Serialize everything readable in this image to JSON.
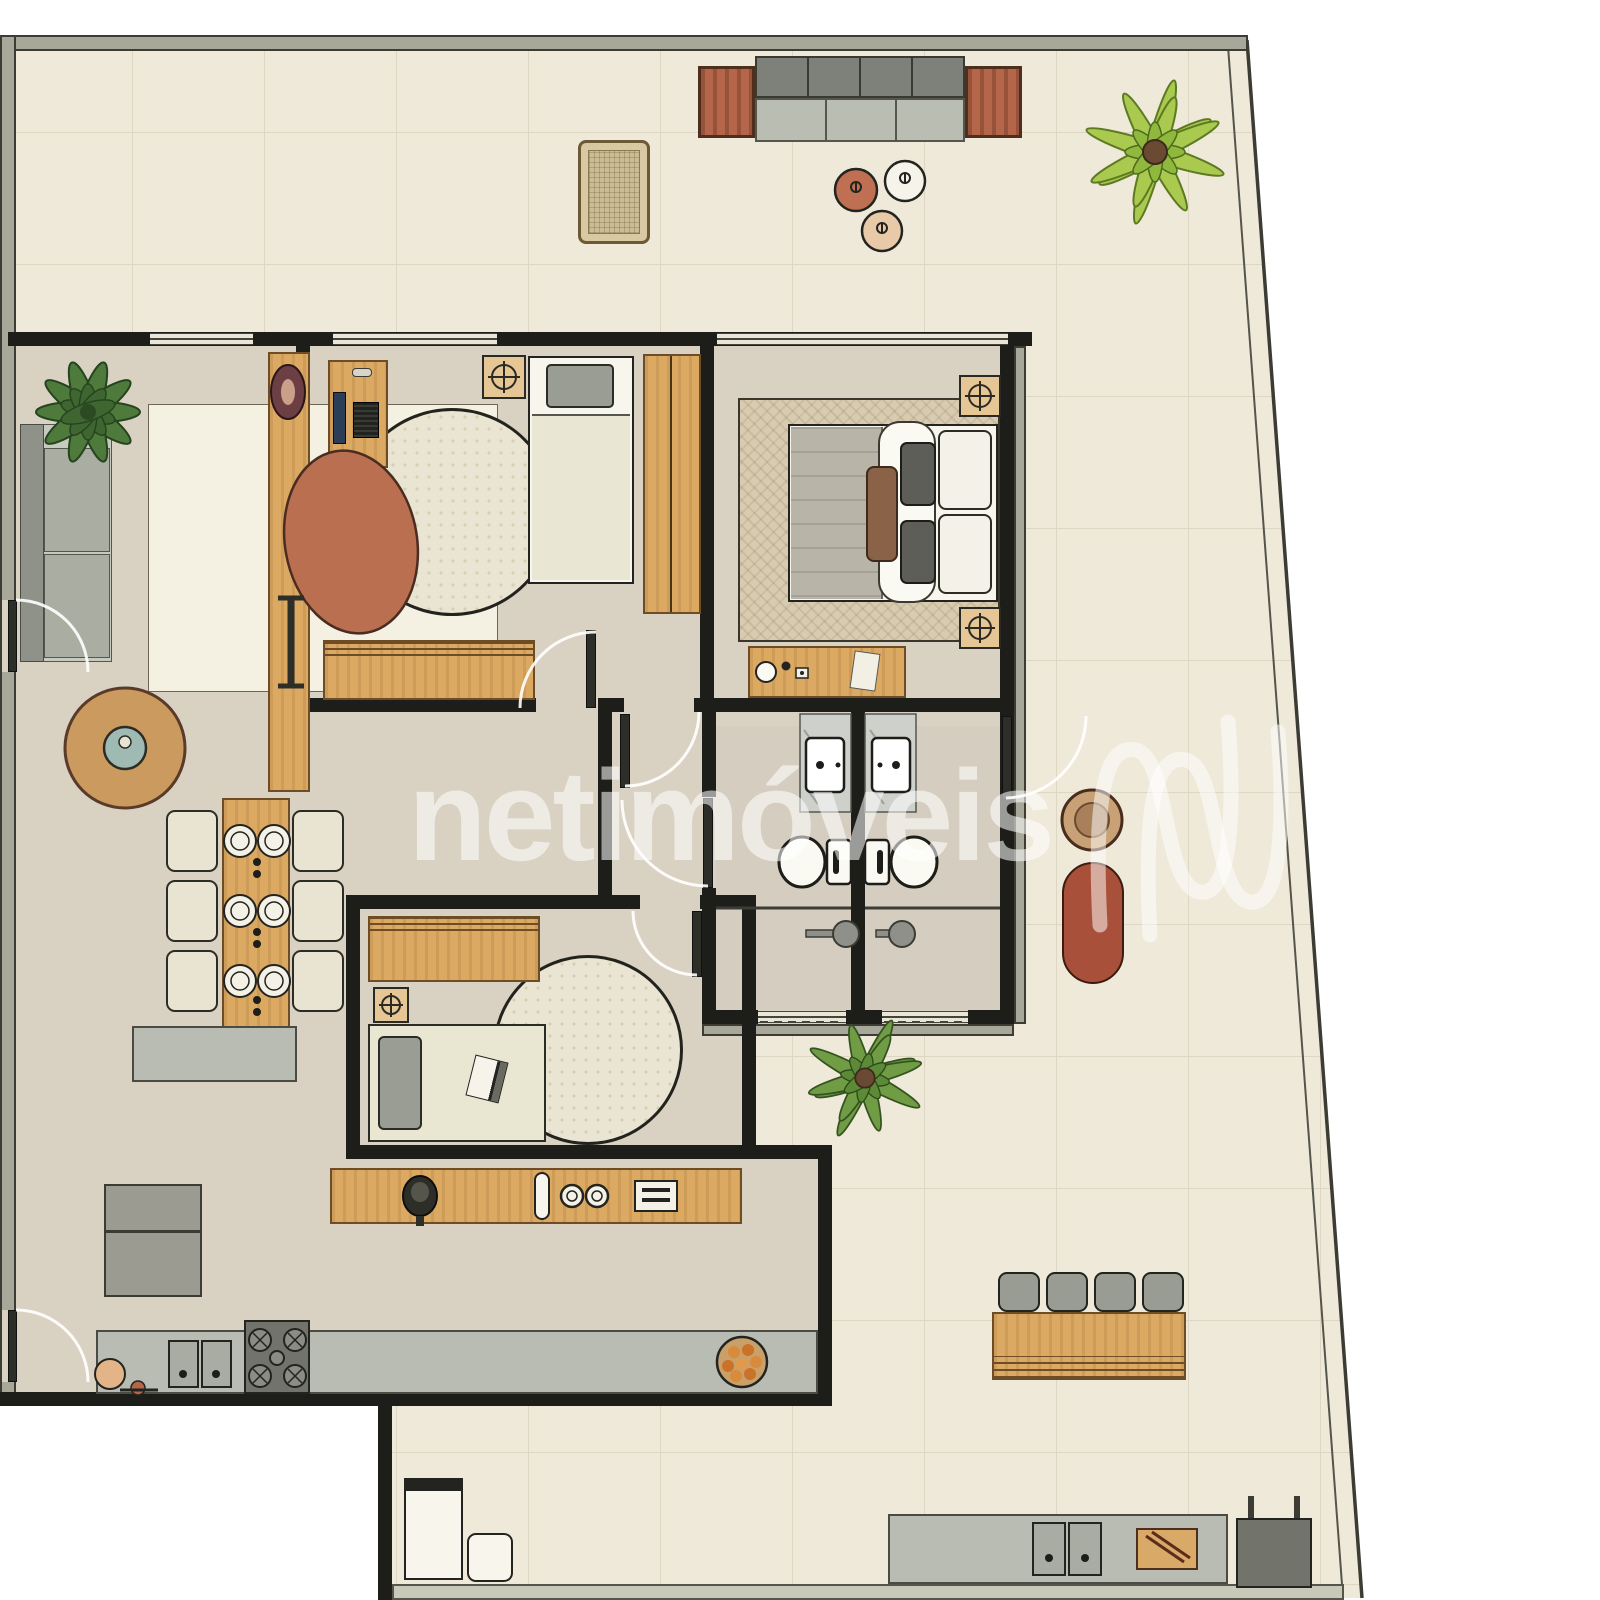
{
  "watermark": {
    "text": "netimóveis",
    "logo": "netimoveis-n-monogram",
    "color": "#ffffff",
    "opacity": 0.56
  },
  "plan": {
    "type": "residential-floor-plan",
    "description": "Top-view furnished apartment floor plan with wrap-around terrace and slanted right boundary",
    "rooms": [
      "terrace",
      "living-room",
      "dining-area",
      "bedroom-2",
      "master-bedroom",
      "hall",
      "bathroom-1",
      "bathroom-2",
      "bedroom-3",
      "kitchen",
      "laundry-area",
      "gourmet-terrace"
    ]
  },
  "palette": {
    "outside": "#ffffff",
    "terrace_floor": "#eee9d9",
    "terrace_grid": "#dcd6c2",
    "interior_floor": "#d9d2c3",
    "wall_interior": "#1d1d19",
    "wall_exterior": "#a7a79a",
    "wood": "#dca963",
    "wood_dark": "#b5654a",
    "counter_gray": "#b9bcb2",
    "appliance_dark": "#72746b",
    "rug_cream": "#f4f0e2",
    "rug_blob": "#b96f50",
    "plant_light": "#a9c94f",
    "plant_dark": "#4e7a3c",
    "pouf_terracotta": "#bf7053",
    "pouf_white": "#f6f3ea",
    "pouf_beige": "#e8c9a8",
    "lounger_red": "#a9503a"
  },
  "furniture_inventory": {
    "terrace": [
      "outdoor-sofa",
      "outdoor-side-table-left",
      "outdoor-side-table-right",
      "lounge-chair",
      "pouf-terracotta",
      "pouf-white",
      "pouf-beige",
      "palm-plant-top",
      "palm-plant-lower",
      "round-decor",
      "sun-lounger",
      "bar-counter",
      "bar-stools-x4",
      "gourmet-counter",
      "double-sink",
      "cutting-board",
      "grill"
    ],
    "living-room": [
      "sofa",
      "side-table",
      "area-rug",
      "rug-blob",
      "tv-console",
      "oval-decor",
      "magazine-bench",
      "potted-plant"
    ],
    "dining-area": [
      "dining-table",
      "dining-chairs-x6",
      "plates",
      "sideboard"
    ],
    "bedroom-2": [
      "desk",
      "monitor",
      "keyboard",
      "ceiling-fan-symbol",
      "single-bed",
      "wardrobe",
      "round-rug",
      "low-sideboard"
    ],
    "master-bedroom": [
      "double-bed",
      "pillows",
      "herringbone-rug",
      "ceiling-fan-symbols",
      "dresser",
      "table-lamp",
      "paper-sheet"
    ],
    "bathrooms": [
      "marble-vanity",
      "sink",
      "toilet",
      "shower-head",
      "glass-partition",
      "window"
    ],
    "bedroom-3": [
      "credenza",
      "ceiling-fan-symbol",
      "round-rug",
      "bed",
      "book"
    ],
    "kitchen": [
      "refrigerator",
      "counter",
      "double-sink",
      "gas-stove",
      "fruit-bowl",
      "breakfast-stool",
      "appliance-counter",
      "coffee-kettle",
      "bottle",
      "cups",
      "toaster"
    ],
    "laundry-area": [
      "washing-machine",
      "laundry-sink"
    ]
  }
}
